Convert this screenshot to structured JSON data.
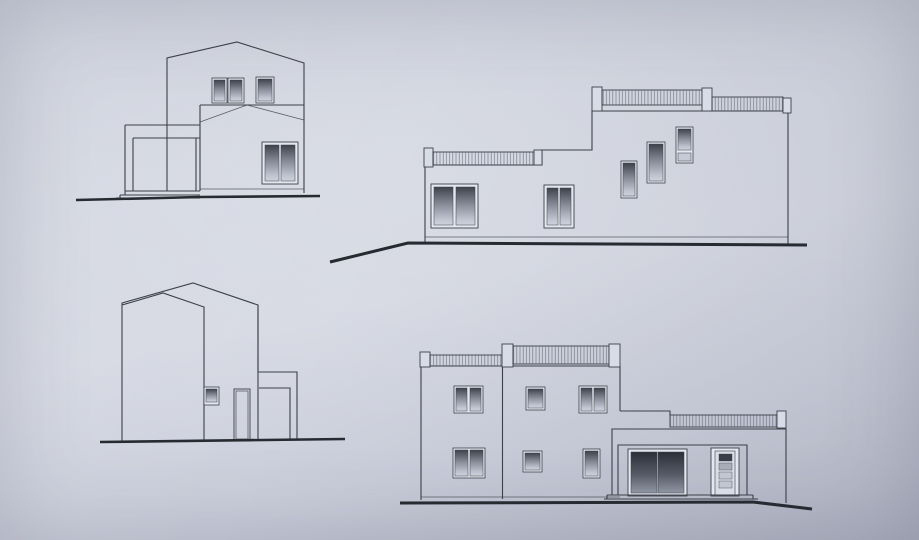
{
  "sheet": {
    "kind": "architectural elevation drawings, photographed paper sheet, no text visible",
    "views": [
      {
        "id": "top-left",
        "name": "side-elevation-with-porch",
        "features": [
          "asymmetric gable roof",
          "three upper-floor windows",
          "hip-roof band over ground floor",
          "double ground-floor window",
          "porch canopy on posts",
          "entry steps",
          "ground line"
        ]
      },
      {
        "id": "top-right",
        "name": "long-elevation-split-levels",
        "features": [
          "two flat-roof levels with balustrade railings",
          "railing end posts",
          "wide double window",
          "narrow double window",
          "three staggered stair windows (top one with bottom pane)",
          "sloping terrain line"
        ]
      },
      {
        "id": "bottom-left",
        "name": "side-elevation-twin-gables",
        "features": [
          "two overlapping gable volumes",
          "small square window",
          "entry door",
          "low annex with opening",
          "ground line"
        ]
      },
      {
        "id": "bottom-right",
        "name": "front-elevation-with-extension",
        "features": [
          "two-story block",
          "roof balustrade railings with posts",
          "three upper windows",
          "three lower windows",
          "single-story extension with railing",
          "recessed porch",
          "dark sliding glass door",
          "panelled entry door",
          "terrace step",
          "sloping ground line"
        ]
      }
    ]
  },
  "colors": {
    "paper": "#cfd3de",
    "line": "#3c4049",
    "ground": "#262a31",
    "frame": "#e4e7ef",
    "post": "#d8dce6",
    "glass_top": "#3e424c",
    "glass_dark_top": "#2b2f38",
    "hatch": "#596070"
  }
}
